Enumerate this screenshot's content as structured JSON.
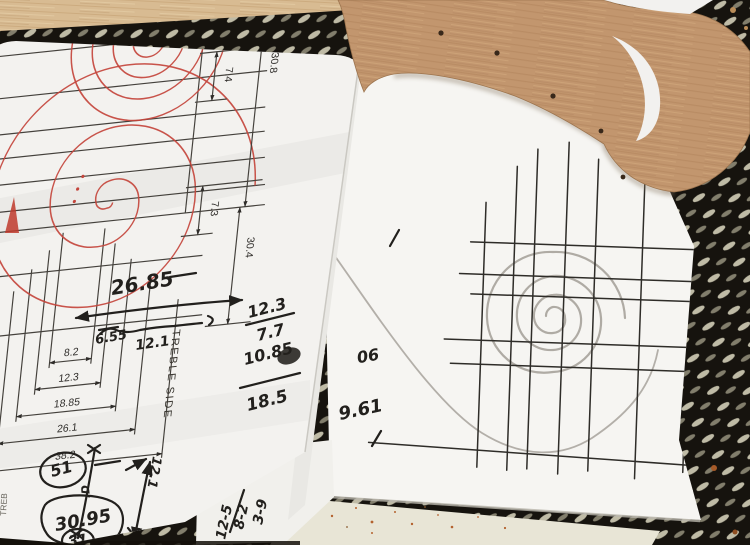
{
  "photo": {
    "printed_sheet": {
      "side_dims": [
        "7.4",
        "30.8",
        "7.3",
        "30.4"
      ],
      "ladder_dims": [
        "8.2",
        "12.3",
        "18.85",
        "26.1",
        "38.2"
      ],
      "side_label": "TREBLE SIDE",
      "edge_label": "TREB",
      "span_note": "26.85",
      "span_left": "6.55",
      "span_right": "12.1",
      "circled_note_1": "51",
      "arrow_note": "12.1",
      "tiny_note": ".D",
      "circled_note_2": "30.95",
      "circled_note_3": "31",
      "sum_column": [
        "12.3",
        "7.7",
        "10.85",
        "18.5"
      ]
    },
    "middle_sheet": {
      "corner_notes": [
        "3-9",
        "8-2",
        "12-5"
      ]
    },
    "grid_sheet": {
      "flipped_note": "90",
      "note": "9.61"
    },
    "colors": {
      "mat": "#17140e",
      "mat_hole": "#d6d2ba",
      "table": "#e8e5d6",
      "wood_strip": "#d8bb92",
      "template_wood": "#c2966e",
      "paper": "#f3f2ef",
      "print_ink": "#44413c",
      "red_line": "#c4453c",
      "pencil": "#a29e96",
      "hand_ink": "#22201d"
    }
  }
}
